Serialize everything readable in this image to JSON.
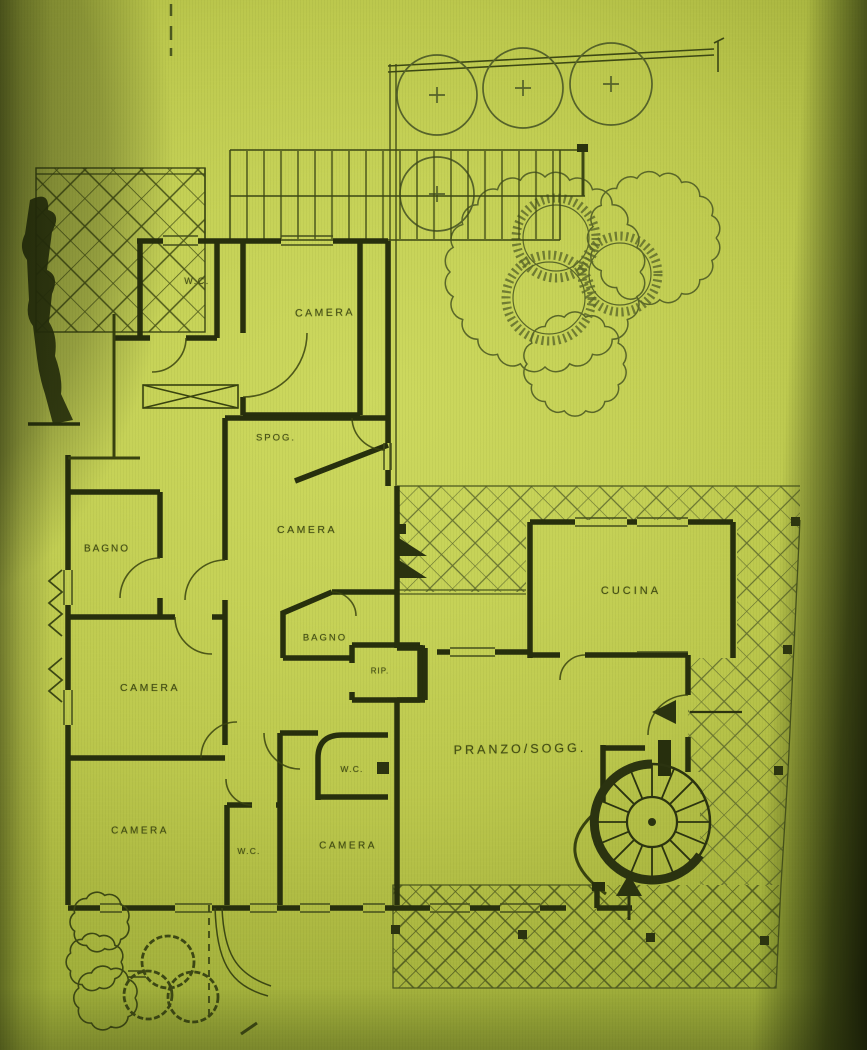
{
  "document": {
    "kind": "floor-plan-photo",
    "language": "it"
  },
  "palette": {
    "paper": "#c5d156",
    "paper_bright": "#cdd95f",
    "paper_shaded": "#9fae3a",
    "ink_wall": "#272f0d",
    "ink_medium": "#38420f",
    "ink_thin": "#4c581f",
    "hatch": "#57632a",
    "hatch_dark": "#49541d",
    "label_ink": "#39430f",
    "shadow": "#161c05"
  },
  "rooms": {
    "wc_top": "W.C.",
    "camera_top": "CAMERA",
    "spogliatoio": "SPOG.",
    "bagno_upper": "BAGNO",
    "camera_middle": "CAMERA",
    "bagno_lower": "BAGNO",
    "ripostiglio": "RIP.",
    "camera_left": "CAMERA",
    "camera_bottom_left": "CAMERA",
    "wc_bottom": "W.C.",
    "camera_bottom_right": "CAMERA",
    "wc_right": "W.C.",
    "cucina": "CUCINA",
    "pranzo_soggiorno": "PRANZO/SOGG."
  },
  "features": {
    "trees": "tree-icon",
    "shrub_canopy": "shrub-icon",
    "hedge": "hedge-icon",
    "terrace_paving": "crosshatch-paving",
    "external_stairs": "stairs-icon",
    "spiral_staircase": "spiral-staircase-icon",
    "entry_arrow": "arrow-icon",
    "wardrobe": "crossed-box-icon"
  }
}
